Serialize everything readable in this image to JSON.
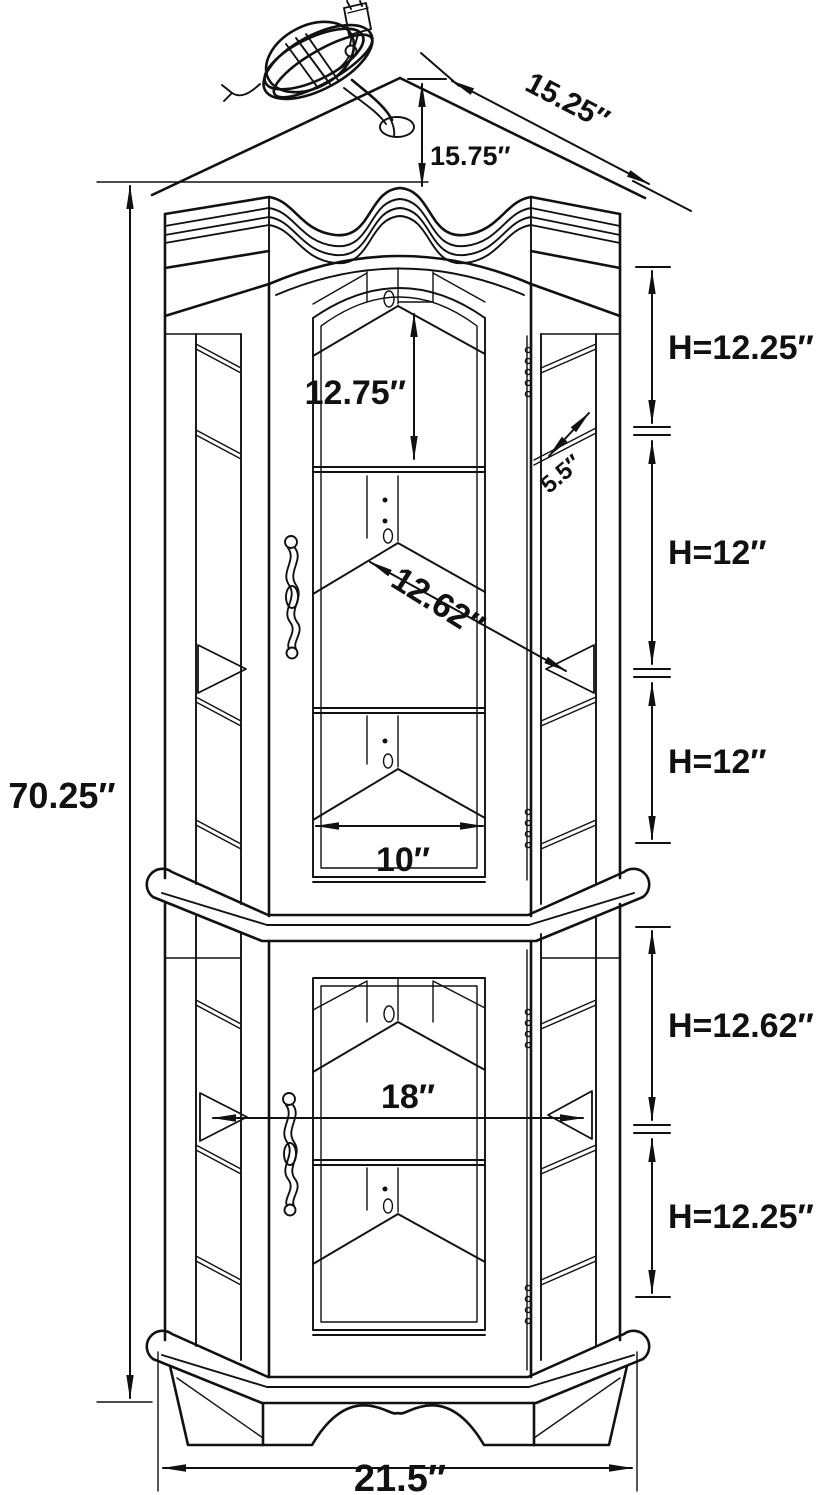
{
  "diagram": {
    "subject": "Corner curio display cabinet — technical dimension line drawing",
    "view": "front three-quarter elevation",
    "background_color": "#ffffff",
    "ink_color": "#111111",
    "features": [
      "power cord with two-prong plug",
      "cord grommet hole in cabinet top",
      "serpentine arched crown molding",
      "upper glass door with ornate handle",
      "lower glass door with ornate handle",
      "angled glass side panels",
      "corner shelves with center back post",
      "piano hinges",
      "waist molding between stacked cabinets",
      "scalloped base apron"
    ]
  },
  "labels": {
    "overall_height": "70.25″",
    "top_width": "15.25″",
    "top_depth": "15.75″",
    "upper_opening_height": "12.75″",
    "side_glass_width": "5.5″",
    "shelf_diagonal_depth": "12.62″",
    "upper_shelf_front_width": "10″",
    "upper_shelf1_height": "H=12.25″",
    "upper_shelf2_height": "H=12″",
    "upper_shelf3_height": "H=12″",
    "lower_shelf1_height": "H=12.62″",
    "lower_shelf2_height": "H=12.25″",
    "lower_interior_width": "18″",
    "base_width": "21.5″"
  }
}
